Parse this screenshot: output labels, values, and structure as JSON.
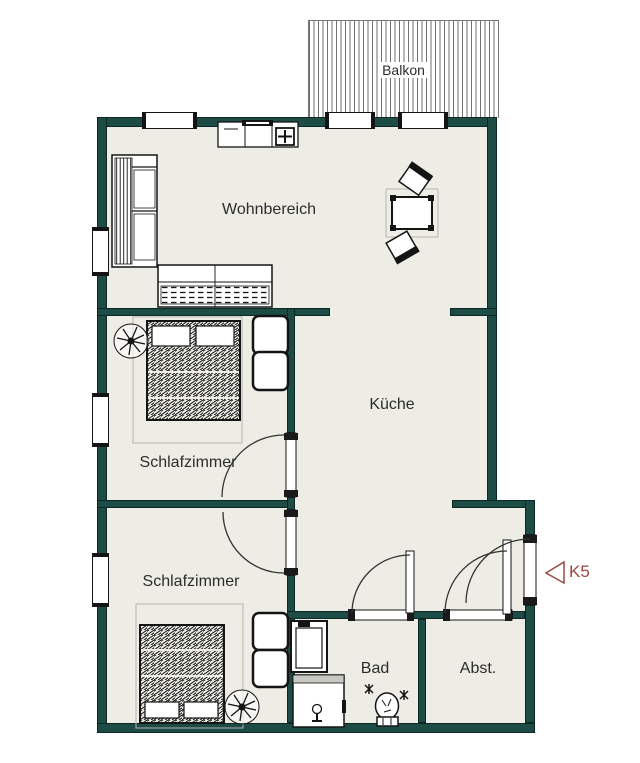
{
  "colors": {
    "wall": "#1d4b45",
    "floor": "#edece5",
    "outline": "#141414",
    "marker": "#9a4a42",
    "label": "#2d2d2d",
    "background": "#ffffff"
  },
  "rooms": {
    "balkon": {
      "label": "Balkon"
    },
    "wohnbereich": {
      "label": "Wohnbereich"
    },
    "kueche": {
      "label": "Küche"
    },
    "schlafzimmer_oben": {
      "label": "Schlafzimmer"
    },
    "schlafzimmer_unten": {
      "label": "Schlafzimmer"
    },
    "bad": {
      "label": "Bad"
    },
    "abstellraum": {
      "label": "Abst."
    }
  },
  "marker": {
    "label": "K5"
  }
}
